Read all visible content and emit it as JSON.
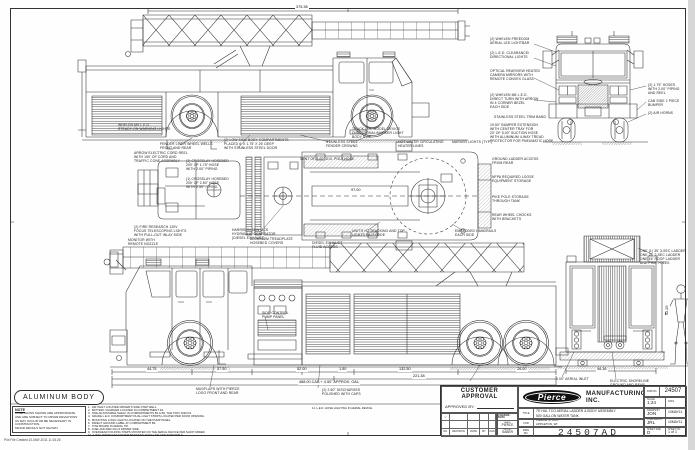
{
  "footer": {
    "body_label": "ALUMINUM BODY",
    "note_title": "NOTE",
    "note_text": "DIMENSIONS SHOWN ARE APPROXIMATE\nAND ARE SUBJECT TO MINOR DEVIATIONS\nAS MAY OCCUR OR BE NECESSARY IN\nCONSTRUCTION.\nMINOR DETAILS NOT SHOWN.",
    "plot_line": "Plot File Created 10-MAY-2011 11:15:26"
  },
  "notes": {
    "items": [
      "1.  AIR INLET LOCATED DRIVER'S SIDE STEP WELL.",
      "2.  BATTERY CHARGER LOCATED IN COMPARTMENT D1.",
      "3.  ONE ADJUSTABLE SHELF IN COMPARTMENTS B1 & B2, THE TRAY AND D4.",
      "4.  GRADE L.E.D. COMPARTMENT DUAL LIGHT STRIPS LOCATED PER DOOR OPENING.",
      "5.  MOUNTING LONG LIGHTS LOCATED ON THE PUMP PANEL.",
      "6.  DIRECT GROUND LABEL AT COMPARTMENT B3.",
      "7.  TOW BOARD IN AERIAL TIP.",
      "8.  FUEL AND DEF FILLS DRIVER SIDE.",
      "9.  OVERHEAD FOLDING STEPS MOUNTED ON THE AERIAL DEVICE PER SHOP ORDER.",
      "10. 2-WAY INTERCOM SYSTEM BETWEEN AERIAL TIP AND TURNTABLE."
    ],
    "extra": "11. L.E.D. HOSE LIGHTING IN AERIAL DEVICE."
  },
  "title_block": {
    "customer_approval": {
      "heading": "CUSTOMER APPROVAL",
      "approved_by_label": "APPROVED BY:",
      "date_label": "DATE:"
    },
    "revision": {
      "symbol": "▽",
      "cols": [
        "NO.",
        "REVISION",
        "DATE",
        "BY",
        "CHK"
      ]
    },
    "chassis": {
      "header": "CHASSIS DATA",
      "make_label": "MAKE",
      "make": "PIERCE",
      "model_label": "MODEL",
      "model": "SABER"
    },
    "brand": "Pierce",
    "company": "MANUFACTURING INC.",
    "labels": {
      "job": "JOB NO.",
      "scale": "SCALE",
      "date": "DATE",
      "title": "TITLE",
      "for": "FOR",
      "dwg": "DWG\nNO.",
      "drawn": "DRAWN BY",
      "checked": "CHECKED BY",
      "size": "SHEET SIZE",
      "sheet": "SHEET NO."
    },
    "job_no": "24507",
    "scale": "1:24",
    "title_line1": "75' HAL TCO AERIAL LADDER & BODY ASSEMBLY",
    "title_line2": "500 GALLON WATER TANK",
    "for_line1": "PIERCE STOCK",
    "for_line2": "APPLETON, WI",
    "dwg_no": "24507AD",
    "drawn_by": "JON",
    "drawn_date": "10MAY11",
    "checked_by": "JRL",
    "checked_date": "10MAY11",
    "size": "D",
    "sheet": "1 of 1"
  },
  "callouts": [
    {
      "x": 118,
      "y": 124,
      "text": "WHELEN M9 L.E.D.\nSTEADY-ON WARNING LIGHTS"
    },
    {
      "x": 160,
      "y": 143,
      "text": "FENDER LINER WHEEL WELLS\nFRONT AND REAR"
    },
    {
      "x": 224,
      "y": 139,
      "text": "(2) LOW SIDE BODY COMPARTMENTS\nPLACED 6' X 1.75' X 26' DEEP\nWITH STAINLESS STEEL DOOR"
    },
    {
      "x": 326,
      "y": 141,
      "text": "STAINLESS STEEL\nFENDER CROWNS"
    },
    {
      "x": 352,
      "y": 128,
      "text": "TRACK-LOC MODEL DEVICE\nDIRECTIONAL/MARKER LIGHT\nBODY SIDE"
    },
    {
      "x": 490,
      "y": 38,
      "text": "(2) WHELEN FREEDOM\nAERIAL LED LIGHTBAR"
    },
    {
      "x": 490,
      "y": 52,
      "text": "(2) L.E.D. CLEARANCE/\nDIRECTIONAL LIGHTS"
    },
    {
      "x": 490,
      "y": 70,
      "text": "OPTICAL REARVIEW HEATED\nCAMERA MIRRORS WITH\nREMOTE CONVEX GLASS"
    },
    {
      "x": 490,
      "y": 94,
      "text": "(2) WHELEN M6 L.E.D.\nDIRECT TURN WITH ARROW\nIN 4 CORNER BEZEL\nEACH SIDE"
    },
    {
      "x": 494,
      "y": 116,
      "text": "STAINLESS STEEL TRIM BAND"
    },
    {
      "x": 490,
      "y": 124,
      "text": "19.50\" BUMPER EXTENSION\nWITH CENTER TRAY FOR\n20' OF 5.00\" SUCTION HOSE\nWITH ALUMINUM 4-WAY TREAD\nPROTECTOR FOR PNEUMATIC HOSE"
    },
    {
      "x": 648,
      "y": 84,
      "text": "(2) 1.75\" HOSES\nWITH 2.00\" PIPING\nAND REEL"
    },
    {
      "x": 648,
      "y": 100,
      "text": "CAB SIDE 2 PIECE\nBUMPER"
    },
    {
      "x": 648,
      "y": 112,
      "text": "(2) AIR HORNS"
    },
    {
      "x": 134,
      "y": 152,
      "text": "ARROW ELECTRIC CORD REEL\nWITH 150' OF CORD AND\nTRAFFIC CONE ASSEMBLY"
    },
    {
      "x": 186,
      "y": 160,
      "text": "(2) CROSSLAY HOSEBED\n200' OF 1.75\" HOSE\nWITH 2.00\" PIPING"
    },
    {
      "x": 186,
      "y": 178,
      "text": "(1) CROSSLAY HOSEBED\n200' OF 2.50\" HOSE\nWITH 2.50\" PIPING"
    },
    {
      "x": 134,
      "y": 226,
      "text": "(2) FIRE RESEARCH 120V\nFOCUS TELESCOPING LIGHTS\nWITH PULL-OUT INLAY SIDE"
    },
    {
      "x": 300,
      "y": 158,
      "text": "VENT OF 3.00\" O.D. POLY HOSE"
    },
    {
      "x": 398,
      "y": 141,
      "text": "HOT WATER CIRCULATING\nHEATER LINES"
    },
    {
      "x": 452,
      "y": 141,
      "text": "MARKER LIGHTS (TYP.)"
    },
    {
      "x": 232,
      "y": 229,
      "text": "HARRISON 6KW MCS\nHYDRAULIC GENERATOR\n(DIESEL EXHAUST)"
    },
    {
      "x": 352,
      "y": 230,
      "text": "UNIT'S H2 TRACKING AND TOP\nLIGHTS EACH SIDE"
    },
    {
      "x": 455,
      "y": 230,
      "text": "EMBEDDED HANDRAILS\nEACH SIDE"
    },
    {
      "x": 492,
      "y": 158,
      "text": "GROUND LADDER ACCESS\nFROM REAR"
    },
    {
      "x": 492,
      "y": 176,
      "text": "NFPA REQUIRED LOOSE\nEQUIPMENT STORAGE"
    },
    {
      "x": 492,
      "y": 196,
      "text": "PIKE POLE STORAGE\nTHROUGH TANK"
    },
    {
      "x": 492,
      "y": 214,
      "text": "REAR WHEEL CHOCKS\nWITH BRACKETS"
    },
    {
      "x": 640,
      "y": 250,
      "text": "ONE (1) 35' 3-SEC LADDER\nONE 28' 2-SEC LADDER\nONE 16' ROOF LADDER\nAND PIKE POLES"
    },
    {
      "x": 556,
      "y": 378,
      "text": "5.00\" AERIAL INLET"
    },
    {
      "x": 610,
      "y": 380,
      "text": "ELECTRIC SHORELINE\nGROUND AND REAR"
    },
    {
      "x": 128,
      "y": 239,
      "text": "MONITOR WITH\nREMOTE NOZZLE"
    },
    {
      "x": 250,
      "y": 238,
      "text": "ALUMINUM TREADPLATE\nHOSEBED COVERS"
    },
    {
      "x": 312,
      "y": 242,
      "text": "DIESEL EXHAUST\nFLUID ACCESS"
    },
    {
      "x": 262,
      "y": 312,
      "text": "SIDE CONTROL\nPUMP PANEL"
    },
    {
      "x": 196,
      "y": 388,
      "text": "MUDFLAPS WITH PIERCE\nLOGO FRONT AND REAR"
    },
    {
      "x": 322,
      "y": 389,
      "text": "(2) 2.50\" DISCHARGES\nPOLISHED WITH CAPS"
    }
  ],
  "dimensions": [
    {
      "x": 295,
      "y": 6,
      "text": "375.38"
    },
    {
      "x": 146,
      "y": 368,
      "text": "44.75"
    },
    {
      "x": 216,
      "y": 368,
      "text": "57.50"
    },
    {
      "x": 296,
      "y": 368,
      "text": "52.00"
    },
    {
      "x": 338,
      "y": 368,
      "text": "1.50"
    },
    {
      "x": 398,
      "y": 368,
      "text": "132.50"
    },
    {
      "x": 516,
      "y": 368,
      "text": "26.00"
    },
    {
      "x": 412,
      "y": 375,
      "text": "221.38"
    },
    {
      "x": 298,
      "y": 381,
      "text": "488.00 CAB + 4.50\" APPROX. OAL"
    },
    {
      "x": 596,
      "y": 368,
      "text": "98.38"
    },
    {
      "x": 666,
      "y": 316,
      "text": "52.25",
      "rot": 1
    },
    {
      "x": 350,
      "y": 189,
      "text": "97.00"
    }
  ]
}
